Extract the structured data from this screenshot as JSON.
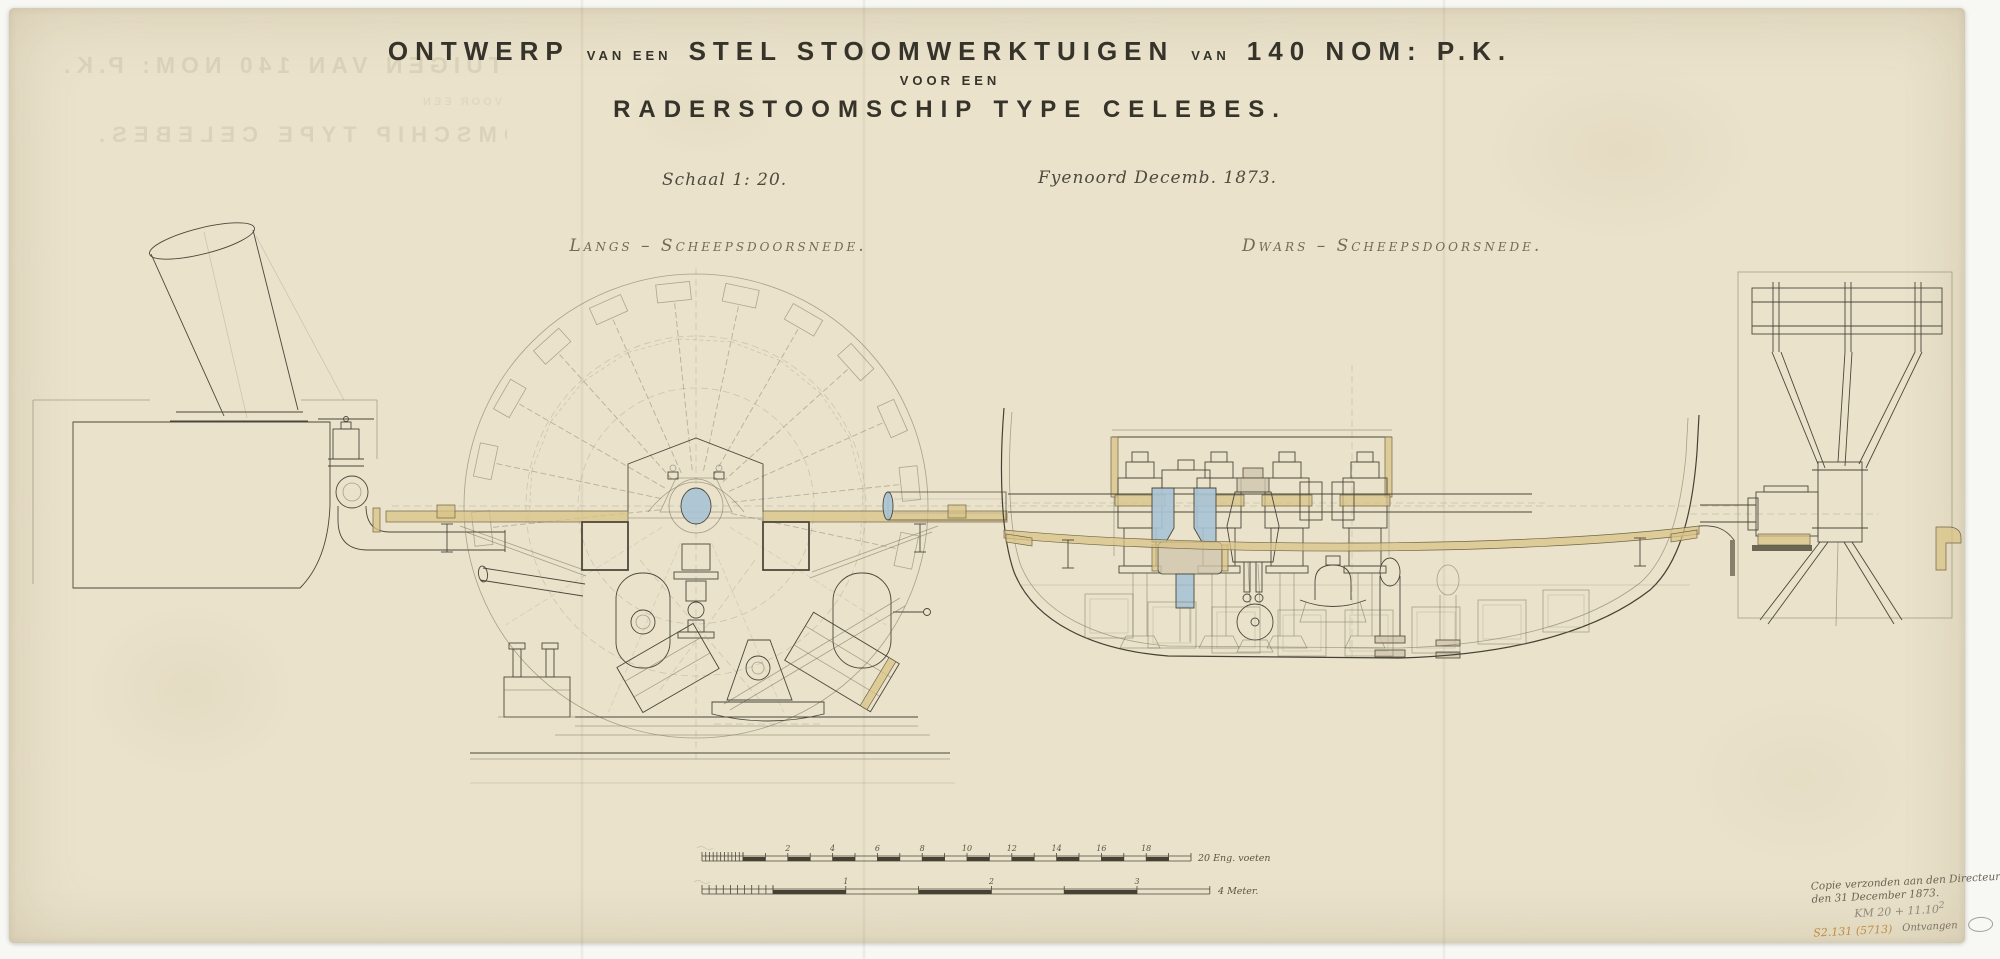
{
  "colors": {
    "backdrop": "#f7f7f4",
    "paper": "#eae2cb",
    "ink": "#4b473a",
    "faint_ink": "#8d8672",
    "accent_blue": "#a8c4d6",
    "accent_yellow": "#d8c387",
    "handwriting_brown": "#6b6353",
    "pencil_gray": "#8f897a",
    "orange_ref_color": "#bf8e3e"
  },
  "title_block": {
    "line1": {
      "word1": "ONTWERP",
      "conn1": "VAN EEN",
      "word2": "STEL STOOMWERKTUIGEN",
      "conn2": "VAN",
      "word3": "140 NOM: P.K."
    },
    "line2": "VOOR EEN",
    "line3": "RADERSTOOMSCHIP TYPE CELEBES.",
    "scale_note": "Schaal 1: 20.",
    "place_date": "Fyenoord Decemb. 1873."
  },
  "section_labels": {
    "left": "Langs – Scheepsdoorsnede.",
    "right": "Dwars – Scheepsdoorsnede."
  },
  "ghost_bleedthrough": {
    "line1": "STEL STOOMWERKTUIGEN VAN 140 NOM: P.K.",
    "line2": "RADERSTOOMSCHIP TYPE CELEBES.",
    "line3": "VOOR EEN"
  },
  "scale_bars": {
    "feet": {
      "tick_labels": [
        "2",
        "4",
        "6",
        "8",
        "10",
        "12",
        "14",
        "16",
        "18"
      ],
      "end_label": "20 Eng. voeten"
    },
    "meters": {
      "tick_labels": [
        "1",
        "2",
        "3"
      ],
      "end_label": "4 Meter."
    }
  },
  "annotations": {
    "note_line1": "Copie verzonden aan den Directeur",
    "note_line2": "den 31 December 1873.",
    "pencil_ref": "KM 20 + 11.10",
    "pencil_sup": "2",
    "orange_ref": "S2.131 (5713)",
    "received_note": "Ontvangen"
  }
}
